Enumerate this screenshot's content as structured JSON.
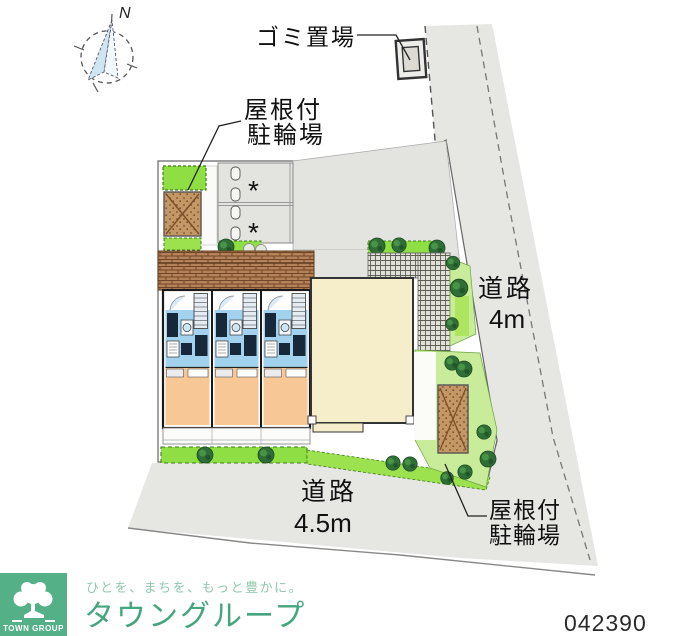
{
  "compass": {
    "north_label": "N"
  },
  "labels": {
    "garbage_area": "ゴミ置場",
    "bike_parking_top": {
      "line1": "屋根付",
      "line2": "駐輪場"
    },
    "road_right": {
      "line1": "道路",
      "line2": "4m"
    },
    "road_bottom": {
      "line1": "道路",
      "line2": "4.5m"
    },
    "bike_parking_bottom": {
      "line1": "屋根付",
      "line2": "駐輪場"
    },
    "parking_stall_mark": "*"
  },
  "footer": {
    "logo_caption": "TOWN GROUP",
    "tagline": "ひとを、まちを、もっと豊かに。",
    "brand": "タウングループ",
    "code": "042390"
  },
  "icons": {
    "compass": "compass-needle-icon",
    "tree": "round-tree-icon",
    "shrub": "shrub-icon",
    "logo_tree": "tree-icon"
  },
  "colors": {
    "road_gray": "#e6e6e3",
    "bush_green": "#8ede44",
    "grass_green": "#c9ec9b",
    "tree_green": "#2f6e36",
    "bike_brown": "#c49766",
    "roof_brown": "#b5825a",
    "floor_blue": "#a2d2ee",
    "room_orange": "#f7c795",
    "building_cream": "#f6eecb",
    "logo_green": "#54b087",
    "brand_green": "#45a67e"
  }
}
